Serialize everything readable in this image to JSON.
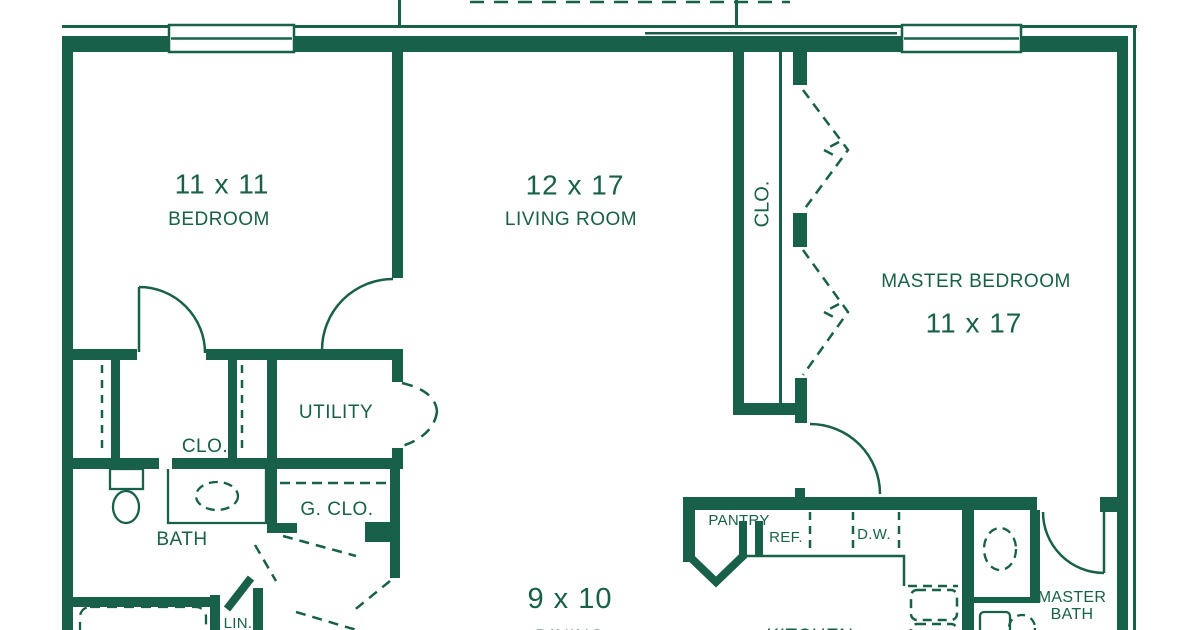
{
  "plan": {
    "colors": {
      "line": "#186049",
      "background": "#ffffff"
    },
    "rooms": {
      "bedroom": {
        "dims": "11 x 11",
        "label": "BEDROOM"
      },
      "living": {
        "dims": "12 x 17",
        "label": "LIVING ROOM"
      },
      "master_bedroom": {
        "label": "MASTER BEDROOM",
        "dims": "11 x 17"
      },
      "dining": {
        "dims": "9 x 10",
        "label": "DINING"
      },
      "kitchen": {
        "label": "KITCHEN"
      },
      "utility": {
        "label": "UTILITY"
      },
      "bath": {
        "label": "BATH"
      },
      "master_bath": {
        "label": "MASTER BATH"
      },
      "bedroom_closet": {
        "label": "CLO."
      },
      "master_closet": {
        "label": "CLO."
      },
      "guest_closet": {
        "label": "G. CLO."
      },
      "pantry": {
        "label": "PANTRY"
      },
      "linen": {
        "label": "LIN."
      }
    },
    "appliances": {
      "refrigerator": "REF.",
      "dishwasher": "D.W."
    }
  }
}
